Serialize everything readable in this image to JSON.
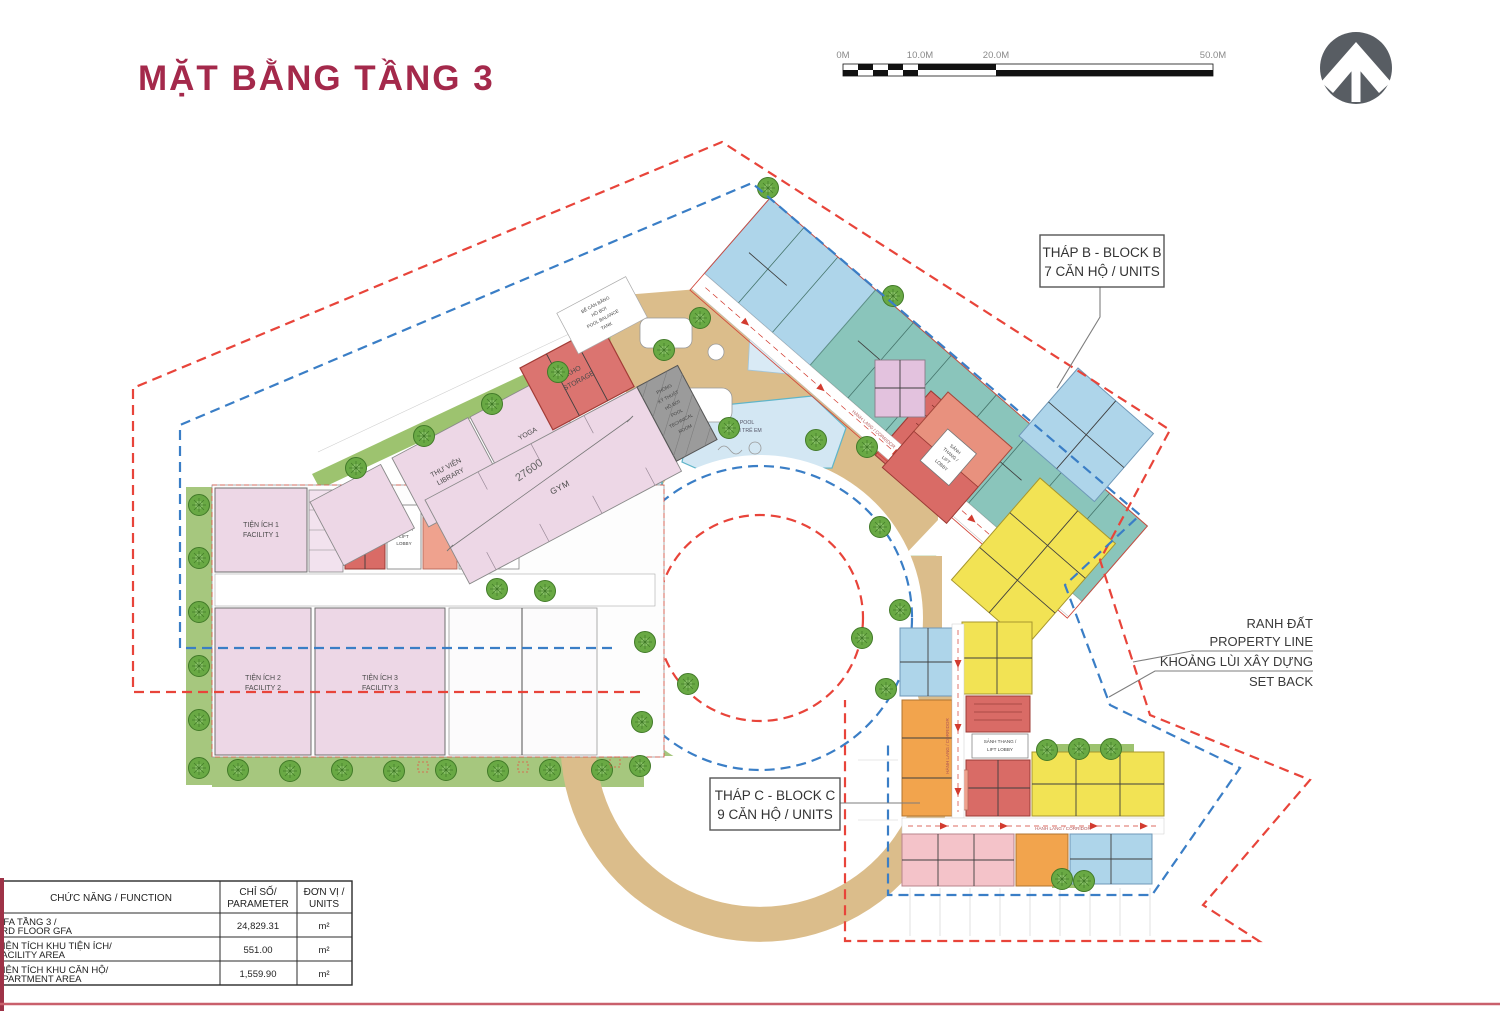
{
  "title": "MẶT BẰNG TẦNG 3",
  "scale": {
    "l0": "0M",
    "l10": "10.0M",
    "l20": "20.0M",
    "l50": "50.0M"
  },
  "callouts": {
    "block_b": {
      "l1": "THÁP B - BLOCK B",
      "l2": "7 CĂN HỘ / UNITS"
    },
    "block_c": {
      "l1": "THÁP C - BLOCK C",
      "l2": "9 CĂN HỘ / UNITS"
    },
    "property": {
      "l1": "RANH ĐẤT",
      "l2": "PROPERTY LINE"
    },
    "setback": {
      "l1": "KHOẢNG LÙI XÂY DỰNG",
      "l2": "SET BACK"
    }
  },
  "rooms": {
    "f1": {
      "l1": "TIỆN ÍCH 1",
      "l2": "FACILITY 1"
    },
    "f2": {
      "l1": "TIỆN ÍCH 2",
      "l2": "FACILITY 2"
    },
    "f3": {
      "l1": "TIỆN ÍCH 3",
      "l2": "FACILITY 3"
    },
    "library": {
      "l1": "THƯ VIỆN",
      "l2": "LIBRARY"
    },
    "yoga": "YOGA",
    "gym": "GYM",
    "storage": {
      "l1": "KHO",
      "l2": "STORAGE"
    },
    "pooltech": {
      "l1": "PHÒNG",
      "l2": "KỸ THUẬT",
      "l3": "HỒ BƠI",
      "l4": "POOL",
      "l5": "TECHNICAL",
      "l6": "ROOM"
    },
    "balance": {
      "l1": "BỂ CÂN BẰNG",
      "l2": "HỒ BƠI",
      "l3": "POOL BALANCE",
      "l4": "TANK"
    },
    "pool": {
      "l1": "SWIMMING POOL",
      "l2": "HỒ BƠI"
    },
    "kidpool": {
      "l1": "KID POOL",
      "l2": "HỒ BƠI TRẺ EM"
    },
    "lobby": {
      "l1": "SẢNH",
      "l2": "THANG /",
      "l3": "LIFT",
      "l4": "LOBBY"
    },
    "lobby2": {
      "l1": "SẢNH THANG /",
      "l2": "LIFT LOBBY"
    },
    "corridor": "HÀNH LANG / CORRIDOR",
    "dim": "27600"
  },
  "table": {
    "h_function": "CHỨC NĂNG / FUNCTION",
    "h_param1": "CHỈ SỐ/",
    "h_param2": "PARAMETER",
    "h_unit1": "ĐƠN VỊ /",
    "h_unit2": "UNITS",
    "rows": [
      {
        "f1": "GFA TẦNG 3 /",
        "f2": "3RD FLOOR GFA",
        "v": "24,829.31",
        "u": "m²"
      },
      {
        "f1": "DIỆN TÍCH KHU TIỆN ÍCH/",
        "f2": "FACILITY AREA",
        "v": "551.00",
        "u": "m²"
      },
      {
        "f1": "DIỆN TÍCH KHU CĂN HỘ/",
        "f2": "APARTMENT AREA",
        "v": "1,559.90",
        "u": "m²"
      }
    ]
  },
  "icons": {
    "north": "north-arrow"
  },
  "colors": {
    "accent": "#A4294B",
    "property_line": "#E8443A",
    "setback": "#3A7EC6",
    "walkway": "#DBBD8B",
    "teal_units": "#8AC5BB",
    "yellow_units": "#F2E354",
    "orange_units": "#F2A44D",
    "red_core": "#D96B66",
    "facility_pink": "#EDD7E6"
  }
}
